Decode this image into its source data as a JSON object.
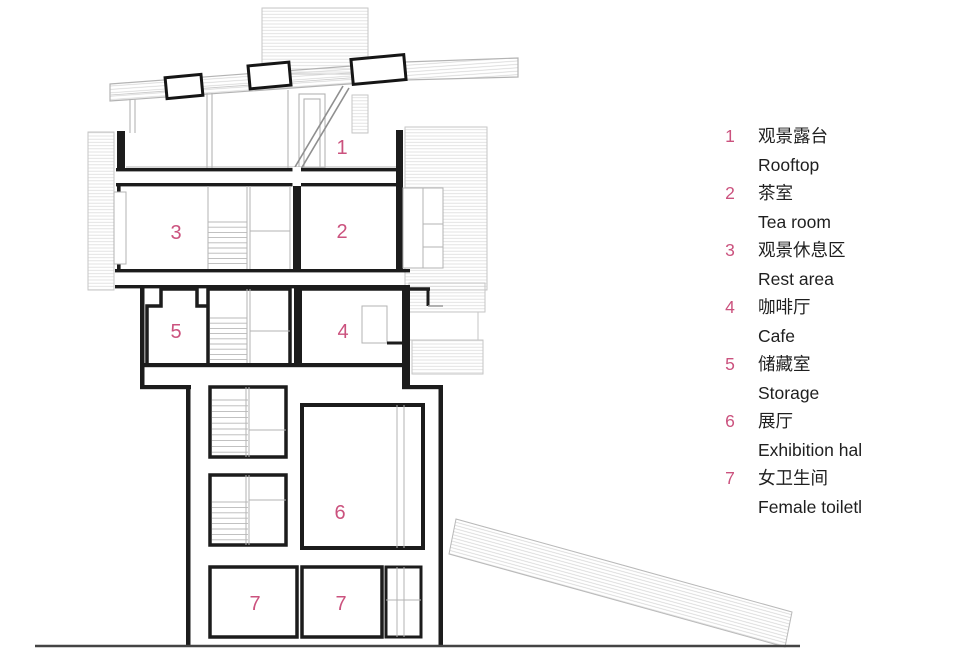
{
  "page": {
    "background": "#ffffff"
  },
  "colors": {
    "accent_pink": "#cb527e",
    "wall_black": "#1c1c1c",
    "line_gray": "#b3b3b3",
    "hatch_gray": "#d9d9d9",
    "ground_gray": "#444444"
  },
  "plan": {
    "labels": [
      {
        "text": "1"
      },
      {
        "text": "2"
      },
      {
        "text": "3"
      },
      {
        "text": "4"
      },
      {
        "text": "5"
      },
      {
        "text": "6"
      },
      {
        "text": "7"
      },
      {
        "text": "7"
      }
    ]
  },
  "legend": {
    "items": [
      {
        "num": "1",
        "zh": "观景露台",
        "en": "Rooftop"
      },
      {
        "num": "2",
        "zh": "茶室",
        "en": "Tea room"
      },
      {
        "num": "3",
        "zh": "观景休息区",
        "en": "Rest area"
      },
      {
        "num": "4",
        "zh": "咖啡厅",
        "en": "Cafe"
      },
      {
        "num": "5",
        "zh": "储藏室",
        "en": "Storage"
      },
      {
        "num": "6",
        "zh": "展厅",
        "en": "Exhibition hal"
      },
      {
        "num": "7",
        "zh": "女卫生间",
        "en": "Female toiletl"
      }
    ]
  }
}
